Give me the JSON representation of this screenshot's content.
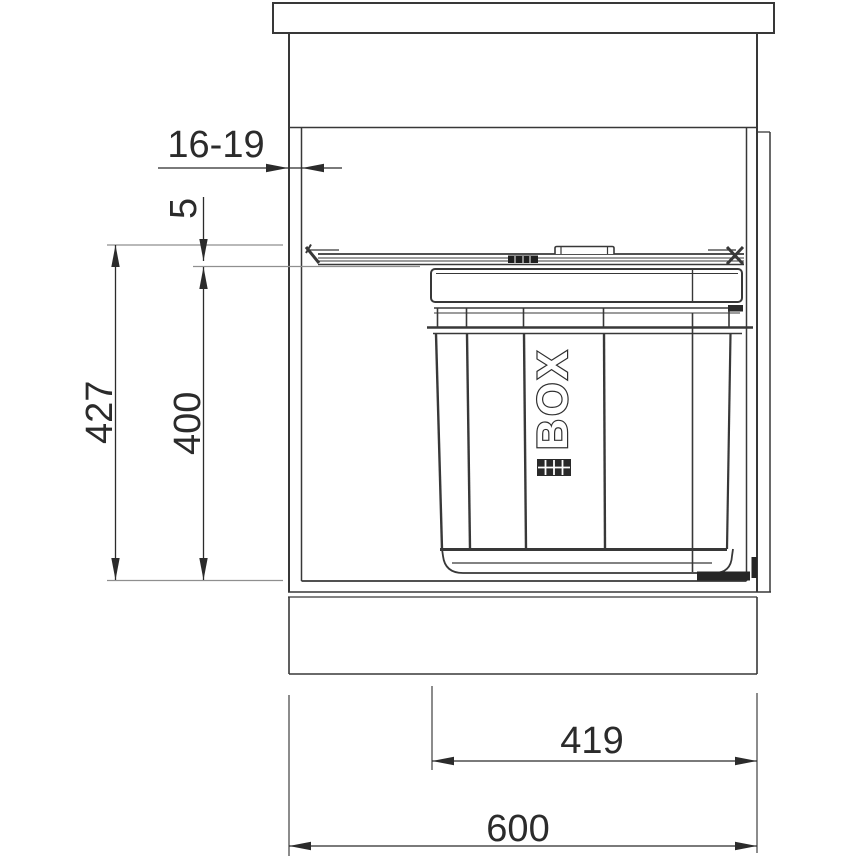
{
  "drawing": {
    "background": "#ffffff",
    "line_color": "#383838",
    "dimension_color": "#2b2b2b",
    "reference_line_color": "#8f8f8f",
    "bin": {
      "logo": "BOX",
      "logo_grid_icon": "grid-icon"
    },
    "dimensions": {
      "top_panel_thickness": "16-19",
      "rail_clearance": "5",
      "inner_height": "427",
      "bin_height": "400",
      "bin_width": "419",
      "cabinet_width": "600"
    }
  }
}
